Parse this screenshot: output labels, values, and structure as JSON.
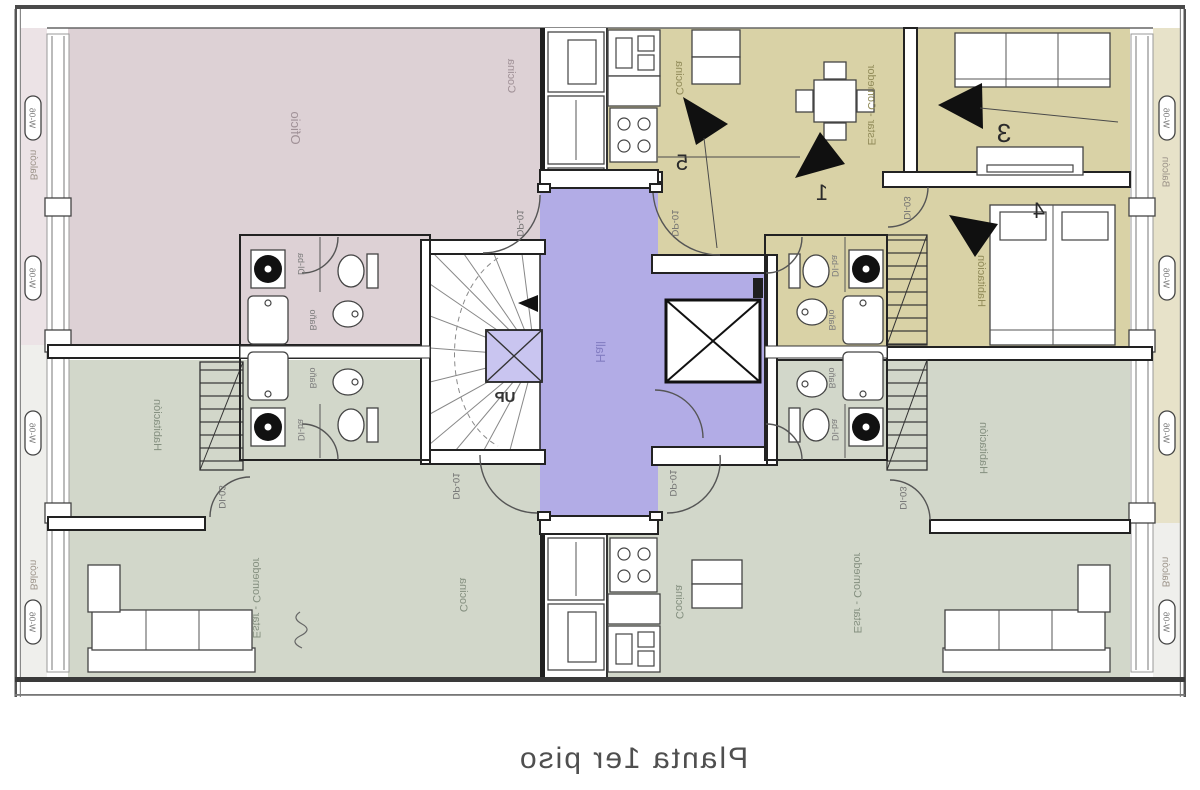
{
  "caption": "Planta 1er piso",
  "labels": {
    "oficio": "Oficio",
    "cocina": "Cocina",
    "estar_comedor": "Estar - Comedor",
    "habitacion": "Habitación",
    "bano": "Baño",
    "hall": "Hall",
    "up": "UP"
  },
  "codes": {
    "door_main": "DP-01",
    "door_interior": "DI-03",
    "door_bath": "DI-ba",
    "window": "W-06",
    "balcony": "Balcón"
  },
  "view_markers": {
    "m1": "1",
    "m3": "3",
    "m4": "4",
    "m5": "5"
  },
  "colors": {
    "tan": "#d9d2a6",
    "pink": "#ddd1d5",
    "green": "#d2d7ca",
    "purple": "#b2ace6",
    "purple_light": "#c9c5f0",
    "balcony_tan": "#e7e2c9",
    "balcony_pink": "#ece3e6",
    "balcony_pale": "#efefec",
    "bath_pink": "#e4dadd",
    "bath_green": "#dadfd3"
  }
}
